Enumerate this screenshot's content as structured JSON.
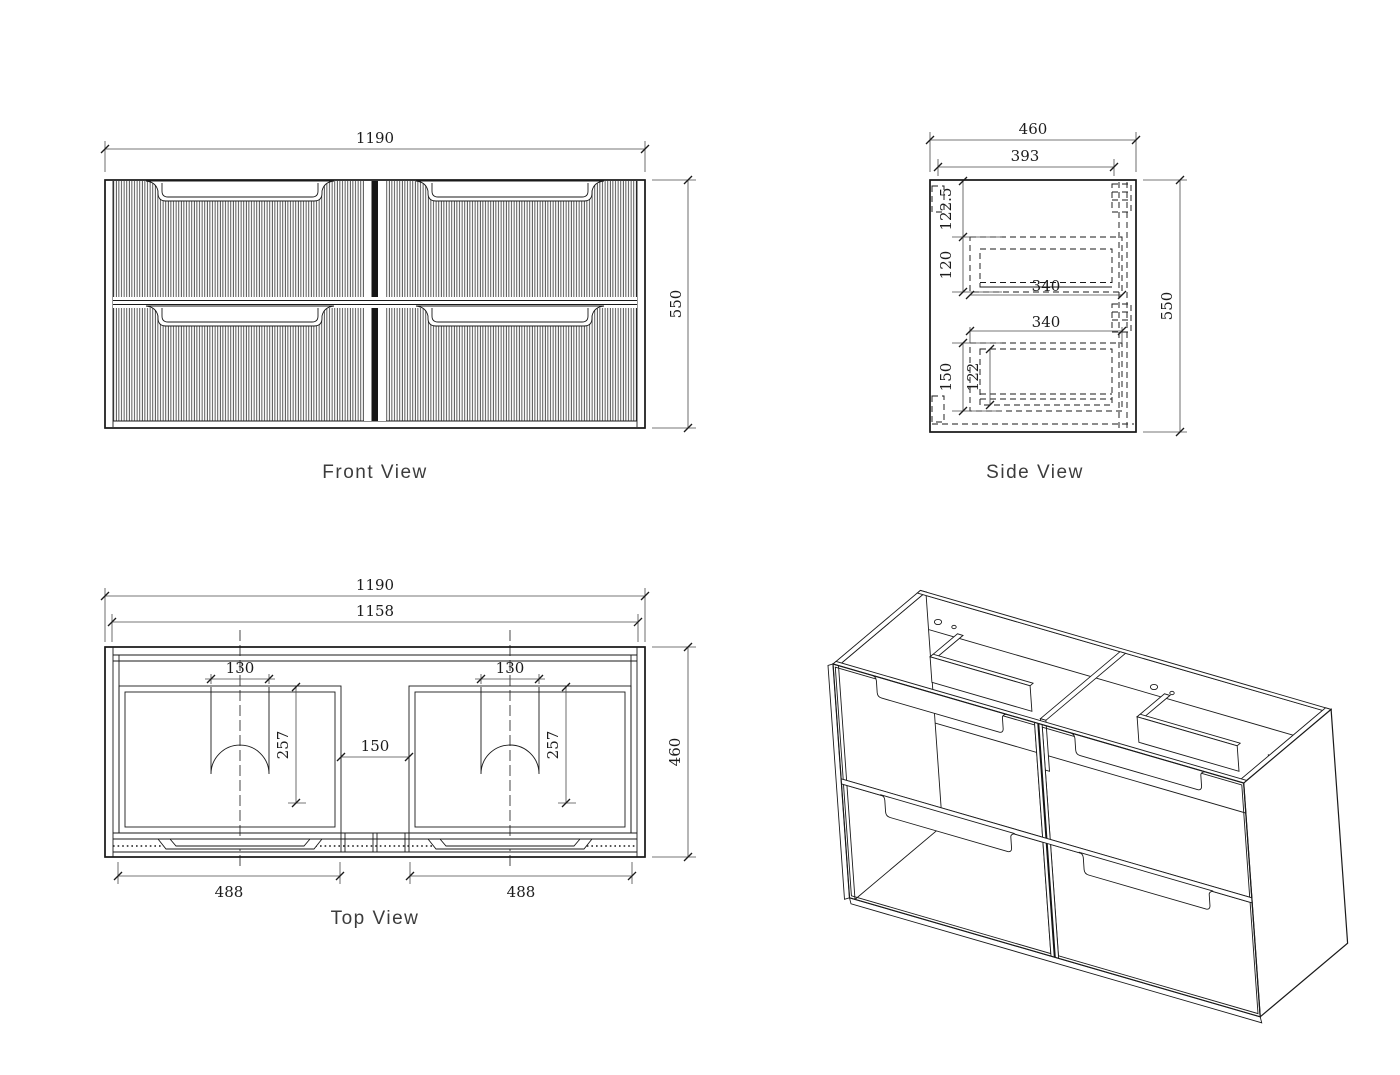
{
  "views": {
    "front": {
      "label": "Front View",
      "dims": {
        "overall_width": "1190",
        "overall_height": "550"
      }
    },
    "side": {
      "label": "Side View",
      "dims": {
        "overall_depth": "460",
        "inner_depth": "393",
        "top_offset": "122.5",
        "upper_drawer_height": "120",
        "upper_drawer_depth": "340",
        "lower_drawer_depth": "340",
        "lower_drawer_height": "150",
        "lower_drawer_inner_height": "122",
        "overall_height": "550"
      }
    },
    "top": {
      "label": "Top View",
      "dims": {
        "overall_width": "1190",
        "inner_width": "1158",
        "left_cutout_width": "130",
        "right_cutout_width": "130",
        "left_cutout_depth": "257",
        "right_cutout_depth": "257",
        "center_gap": "150",
        "overall_depth": "460",
        "left_drawer_width": "488",
        "right_drawer_width": "488"
      }
    },
    "isometric": {
      "label": ""
    }
  }
}
